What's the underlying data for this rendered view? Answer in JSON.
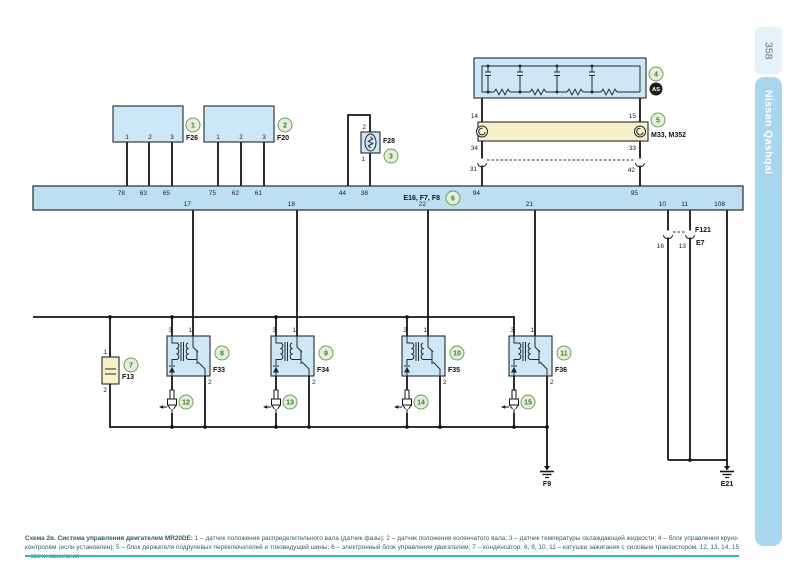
{
  "sidebar": {
    "page_number": "358",
    "edition": "Nissan Qashqai"
  },
  "caption": {
    "title": "Схема 2в. Система управления двигателем MR20DE:",
    "body": " 1 – датчик положения распределительного вала (датчик фазы); 2 – датчик положения коленчатого вала; 3 – датчик температуры охлаждающей жидкости; 4 – блок управления круиз-контролем (если установлен); 5 – блок держателя подрулевых переключателей и токоведущей шины; 6 – электронный блок управления двигателем; 7 – конденсатор; 8, 9, 10, 11 – катушки зажигания с силовым транзистором; 12, 13, 14, 15 – свечи зажигания"
  },
  "diagram": {
    "bus": {
      "ref": "6",
      "name": "E16, F7, F8",
      "pins_top": [
        "78",
        "63",
        "65",
        "75",
        "62",
        "61",
        "44",
        "38",
        "94",
        "95"
      ],
      "pins_bottom": [
        "17",
        "18",
        "22",
        "21",
        "10",
        "11",
        "108"
      ]
    },
    "sensor1": {
      "ref": "1",
      "name": "F26",
      "pins": [
        "1",
        "2",
        "3"
      ]
    },
    "sensor2": {
      "ref": "2",
      "name": "F20",
      "pins": [
        "1",
        "2",
        "3"
      ]
    },
    "sensor3": {
      "ref": "3",
      "name": "F28",
      "pin_top": "2",
      "pin_bottom": "1"
    },
    "cruise": {
      "ref": "4",
      "badge": "AS",
      "pin_left": "14",
      "pin_right": "15"
    },
    "spiral": {
      "ref": "5",
      "name": "M33, M352",
      "pin_left": "34",
      "pin_right": "33",
      "conn_left": "31",
      "conn_right": "42"
    },
    "capacitor": {
      "ref": "7",
      "name": "F13",
      "pin_top": "1",
      "pin_bottom": "2"
    },
    "coils": [
      {
        "ref": "8",
        "name": "F33",
        "pin_a": "3",
        "pin_b": "1",
        "pin_c": "2"
      },
      {
        "ref": "9",
        "name": "F34",
        "pin_a": "3",
        "pin_b": "1",
        "pin_c": "2"
      },
      {
        "ref": "10",
        "name": "F35",
        "pin_a": "3",
        "pin_b": "1",
        "pin_c": "2"
      },
      {
        "ref": "11",
        "name": "F36",
        "pin_a": "3",
        "pin_b": "1",
        "pin_c": "2"
      }
    ],
    "plugs": [
      {
        "ref": "12"
      },
      {
        "ref": "13"
      },
      {
        "ref": "14"
      },
      {
        "ref": "15"
      }
    ],
    "connector": {
      "top": "F121",
      "bottom": "E7",
      "pin_left": "16",
      "pin_right": "13"
    },
    "ground_left": "F9",
    "ground_right": "E21"
  }
}
